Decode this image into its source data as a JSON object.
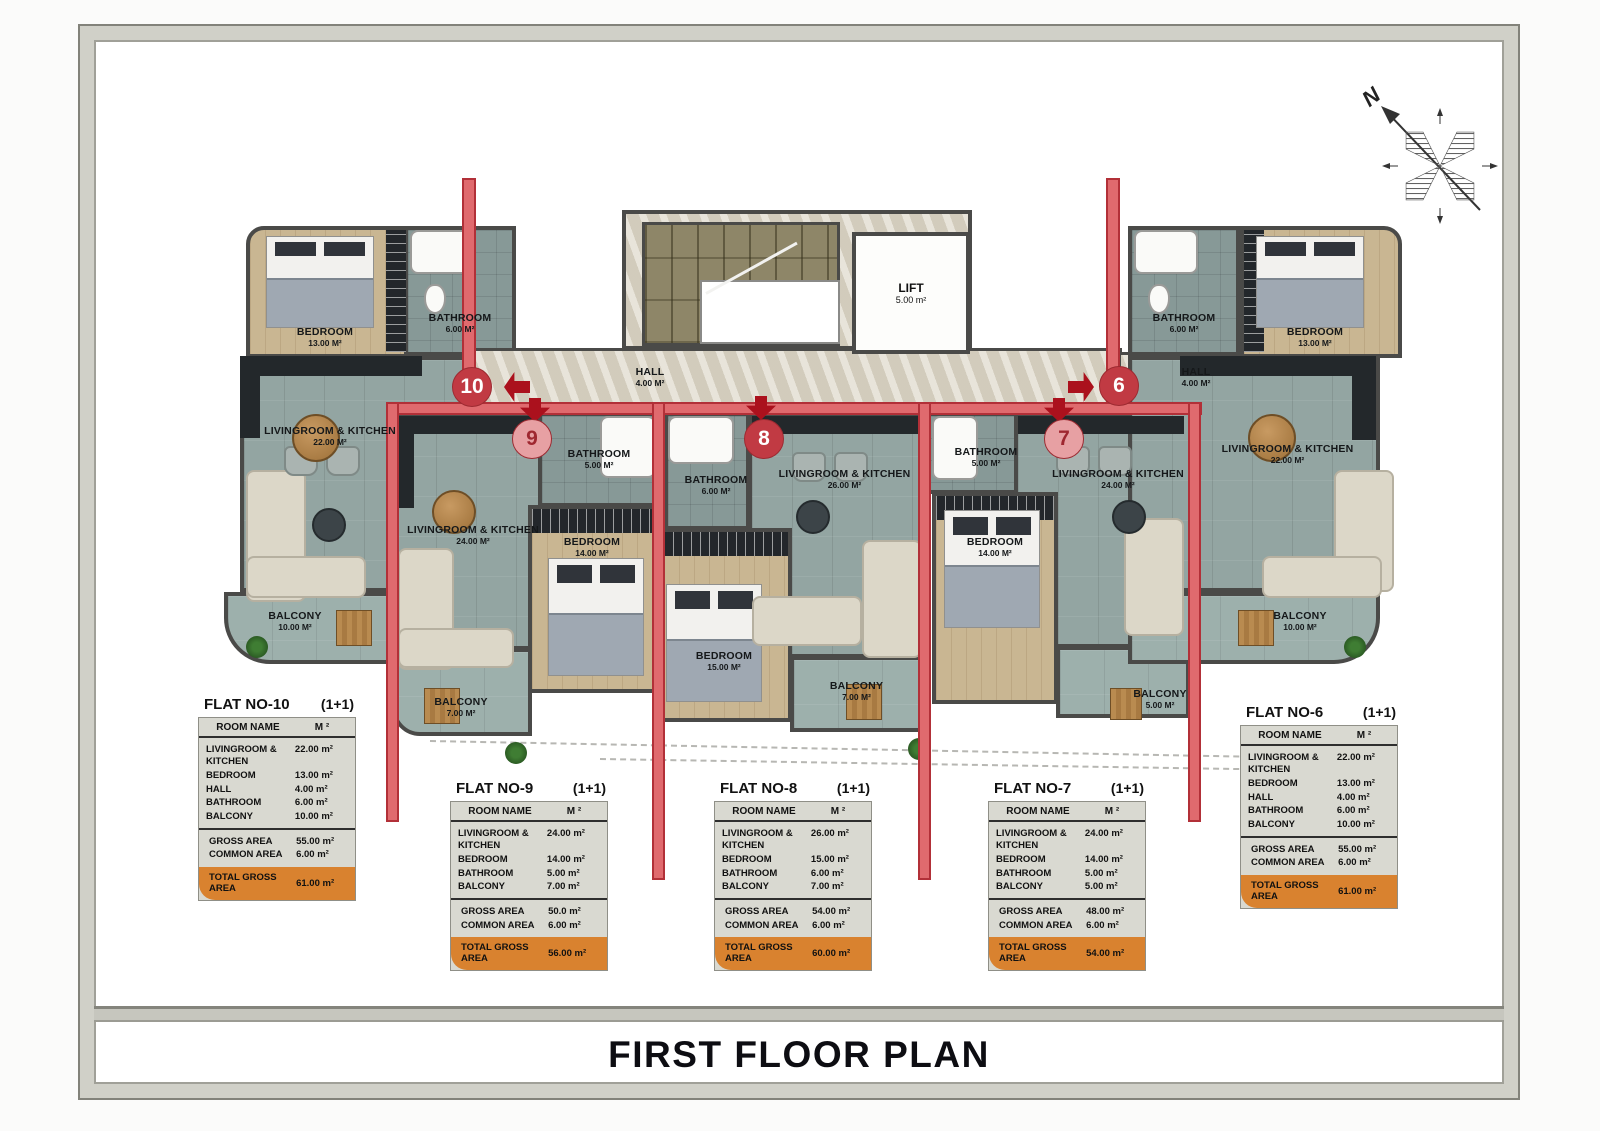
{
  "title": "FIRST FLOOR PLAN",
  "compass": {
    "north": "N"
  },
  "plan": {
    "lift": {
      "name": "LIFT",
      "area": "5.00 m²"
    },
    "flats": {
      "f10": {
        "badge": "10",
        "bedroom": {
          "name": "BEDROOM",
          "area": "13.00 m²"
        },
        "bathroom": {
          "name": "BATHROOM",
          "area": "6.00 m²"
        },
        "hall": {
          "name": "HALL",
          "area": "4.00 m²"
        },
        "livingroom": {
          "name": "LIVINGROOM & KITCHEN",
          "area": "22.00 m²"
        },
        "balcony": {
          "name": "BALCONY",
          "area": "10.00 m²"
        }
      },
      "f9": {
        "badge": "9",
        "bathroom": {
          "name": "BATHROOM",
          "area": "5.00 m²"
        },
        "livingroom": {
          "name": "LIVINGROOM & KITCHEN",
          "area": "24.00 m²"
        },
        "bedroom": {
          "name": "BEDROOM",
          "area": "14.00 m²"
        },
        "balcony": {
          "name": "BALCONY",
          "area": "7.00 m²"
        }
      },
      "f8": {
        "badge": "8",
        "bathroom": {
          "name": "BATHROOM",
          "area": "6.00 m²"
        },
        "livingroom": {
          "name": "LIVINGROOM & KITCHEN",
          "area": "26.00 m²"
        },
        "bedroom": {
          "name": "BEDROOM",
          "area": "15.00 m²"
        },
        "balcony": {
          "name": "BALCONY",
          "area": "7.00 m²"
        }
      },
      "f7": {
        "badge": "7",
        "bathroom": {
          "name": "BATHROOM",
          "area": "5.00 m²"
        },
        "livingroom": {
          "name": "LIVINGROOM & KITCHEN",
          "area": "24.00 m²"
        },
        "bedroom": {
          "name": "BEDROOM",
          "area": "14.00 m²"
        },
        "balcony": {
          "name": "BALCONY",
          "area": "5.00 m²"
        }
      },
      "f6": {
        "badge": "6",
        "bathroom": {
          "name": "BATHROOM",
          "area": "6.00 m²"
        },
        "bedroom": {
          "name": "BEDROOM",
          "area": "13.00 m²"
        },
        "hall": {
          "name": "HALL",
          "area": "4.00 m²"
        },
        "livingroom": {
          "name": "LIVINGROOM & KITCHEN",
          "area": "22.00 m²"
        },
        "balcony": {
          "name": "BALCONY",
          "area": "10.00 m²"
        }
      }
    }
  },
  "colors": {
    "accent_red": "#c13a43",
    "wall_red": "#e06a6e",
    "total_orange": "#d9822f",
    "floor_green": "#93a5a2",
    "floor_wood": "#c9b692",
    "corridor_marble": "#d9d2c2"
  },
  "tables": [
    {
      "flat_no": "FLAT NO-10",
      "type": "(1+1)",
      "header": {
        "room": "ROOM NAME",
        "unit": "M ²"
      },
      "rows": [
        [
          "LIVINGROOM & KITCHEN",
          "22.00 m²"
        ],
        [
          "BEDROOM",
          "13.00 m²"
        ],
        [
          "HALL",
          "4.00 m²"
        ],
        [
          "BATHROOM",
          "6.00 m²"
        ],
        [
          "BALCONY",
          "10.00 m²"
        ]
      ],
      "summary": [
        [
          "GROSS AREA",
          "55.00 m²"
        ],
        [
          "COMMON AREA",
          "6.00 m²"
        ]
      ],
      "total": [
        "TOTAL GROSS AREA",
        "61.00 m²"
      ]
    },
    {
      "flat_no": "FLAT NO-9",
      "type": "(1+1)",
      "header": {
        "room": "ROOM NAME",
        "unit": "M ²"
      },
      "rows": [
        [
          "LIVINGROOM & KITCHEN",
          "24.00 m²"
        ],
        [
          "BEDROOM",
          "14.00 m²"
        ],
        [
          "BATHROOM",
          "5.00 m²"
        ],
        [
          "BALCONY",
          "7.00 m²"
        ]
      ],
      "summary": [
        [
          "GROSS AREA",
          "50.0 m²"
        ],
        [
          "COMMON AREA",
          "6.00 m²"
        ]
      ],
      "total": [
        "TOTAL GROSS AREA",
        "56.00 m²"
      ]
    },
    {
      "flat_no": "FLAT NO-8",
      "type": "(1+1)",
      "header": {
        "room": "ROOM NAME",
        "unit": "M ²"
      },
      "rows": [
        [
          "LIVINGROOM & KITCHEN",
          "26.00 m²"
        ],
        [
          "BEDROOM",
          "15.00 m²"
        ],
        [
          "BATHROOM",
          "6.00 m²"
        ],
        [
          "BALCONY",
          "7.00 m²"
        ]
      ],
      "summary": [
        [
          "GROSS AREA",
          "54.00 m²"
        ],
        [
          "COMMON AREA",
          "6.00 m²"
        ]
      ],
      "total": [
        "TOTAL GROSS AREA",
        "60.00 m²"
      ]
    },
    {
      "flat_no": "FLAT NO-7",
      "type": "(1+1)",
      "header": {
        "room": "ROOM NAME",
        "unit": "M ²"
      },
      "rows": [
        [
          "LIVINGROOM & KITCHEN",
          "24.00 m²"
        ],
        [
          "BEDROOM",
          "14.00 m²"
        ],
        [
          "BATHROOM",
          "5.00 m²"
        ],
        [
          "BALCONY",
          "5.00 m²"
        ]
      ],
      "summary": [
        [
          "GROSS AREA",
          "48.00 m²"
        ],
        [
          "COMMON AREA",
          "6.00 m²"
        ]
      ],
      "total": [
        "TOTAL GROSS AREA",
        "54.00 m²"
      ]
    },
    {
      "flat_no": "FLAT NO-6",
      "type": "(1+1)",
      "header": {
        "room": "ROOM NAME",
        "unit": "M ²"
      },
      "rows": [
        [
          "LIVINGROOM & KITCHEN",
          "22.00 m²"
        ],
        [
          "BEDROOM",
          "13.00 m²"
        ],
        [
          "HALL",
          "4.00 m²"
        ],
        [
          "BATHROOM",
          "6.00 m²"
        ],
        [
          "BALCONY",
          "10.00 m²"
        ]
      ],
      "summary": [
        [
          "GROSS AREA",
          "55.00 m²"
        ],
        [
          "COMMON AREA",
          "6.00 m²"
        ]
      ],
      "total": [
        "TOTAL GROSS AREA",
        "61.00 m²"
      ]
    }
  ]
}
